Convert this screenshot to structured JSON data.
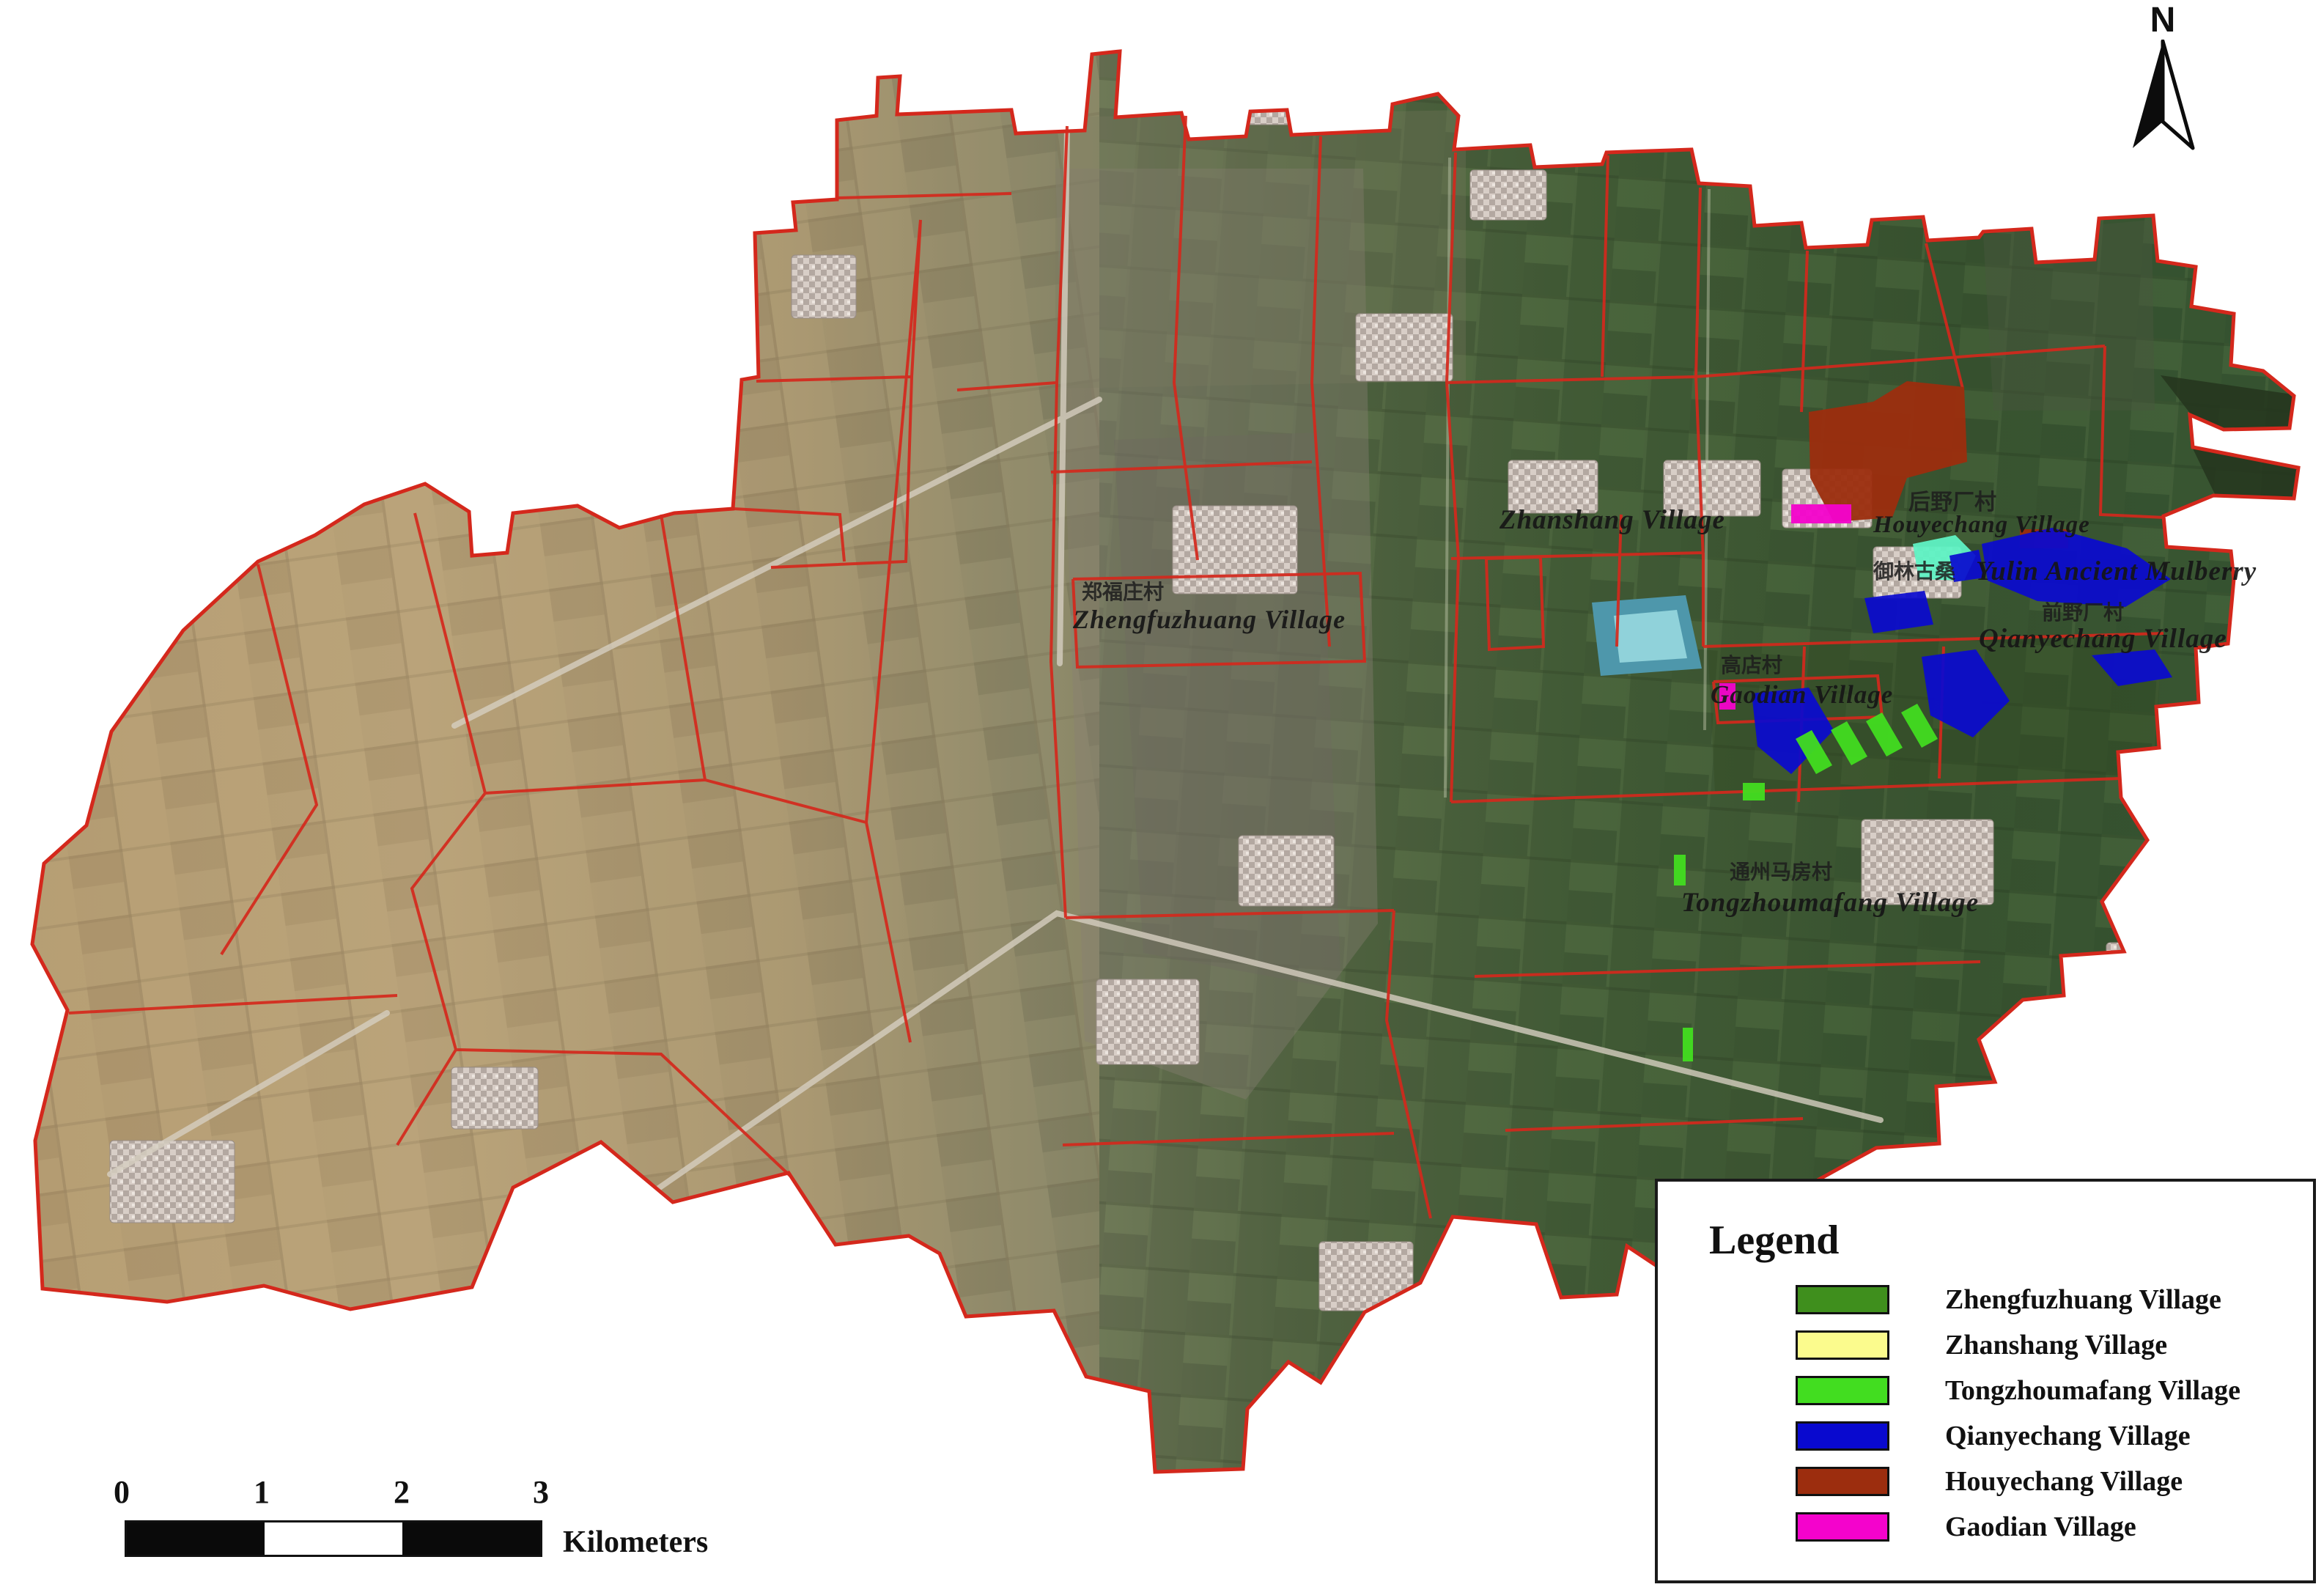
{
  "north_arrow": {
    "label": "N"
  },
  "map_labels": {
    "zhengfuzhuang": {
      "zh": "郑福庄村",
      "en": "Zhengfuzhuang Village"
    },
    "zhanshang": {
      "en": "Zhanshang Village"
    },
    "houyechang": {
      "zh": "后野厂村",
      "en": "Houyechang Village"
    },
    "yulin_mulberry": {
      "zh": "御林古桑",
      "en": "Yulin Ancient Mulberry"
    },
    "qianyechang": {
      "zh": "前野厂村",
      "en": "Qianyechang Village"
    },
    "gaodian": {
      "zh": "高店村",
      "en": "Gaodian Village"
    },
    "tongzhoumafang": {
      "zh": "通州马房村",
      "en": "Tongzhoumafang Village"
    }
  },
  "legend": {
    "title": "Legend",
    "items": [
      {
        "label": "Zhengfuzhuang Village",
        "color": "#3f8f1d"
      },
      {
        "label": "Zhanshang Village",
        "color": "#fbfb8d"
      },
      {
        "label": "Tongzhoumafang Village",
        "color": "#42dd20"
      },
      {
        "label": "Qianyechang Village",
        "color": "#0909cf"
      },
      {
        "label": "Houyechang Village",
        "color": "#9c2d0e"
      },
      {
        "label": "Gaodian Village",
        "color": "#f403cc"
      }
    ]
  },
  "scale_bar": {
    "ticks": [
      "0",
      "1",
      "2",
      "3"
    ],
    "unit": "Kilometers"
  },
  "map_colors": {
    "boundary": "#d4281c",
    "water": "#58a2b4"
  }
}
